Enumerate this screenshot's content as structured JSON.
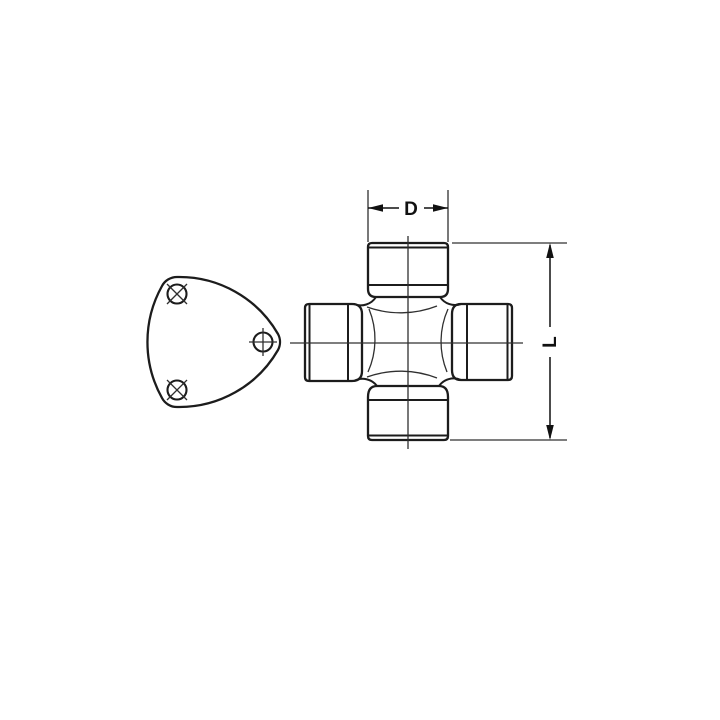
{
  "colors": {
    "background": "#ffffff",
    "line": "#1c1c1c",
    "thin_line": "#303030",
    "dim_line": "#111111",
    "text": "#111111"
  },
  "labels": {
    "diameter": "D",
    "length": "L"
  },
  "parts": {
    "flange": "triangular-mounting-flange",
    "flange_bolt_holes": 3,
    "spider": "universal-joint-cross",
    "bearing_cups": 4
  }
}
